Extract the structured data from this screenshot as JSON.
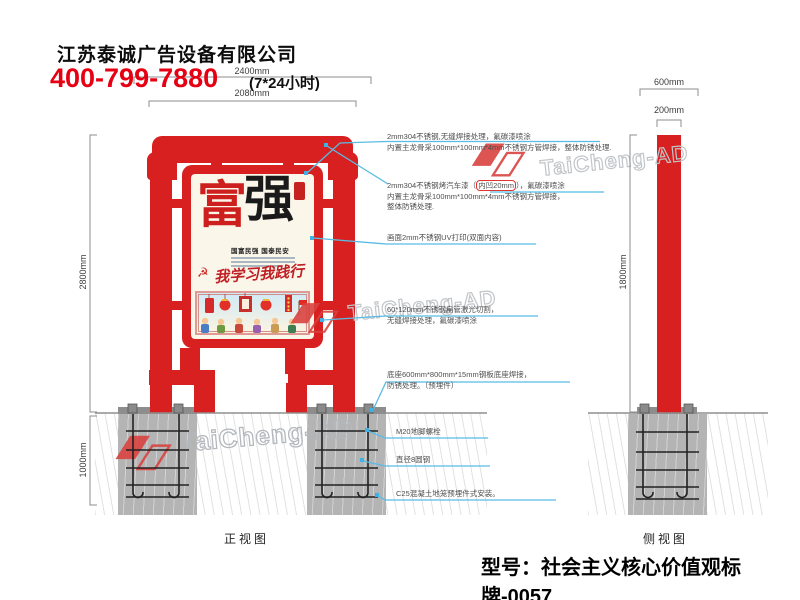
{
  "header": {
    "company": "江苏泰诚广告设备有限公司",
    "phone": "400-799-7880",
    "hours": "(7*24小时)"
  },
  "views": {
    "front_label": "正视图",
    "side_label": "侧视图"
  },
  "dimensions": {
    "front_total_width": "2400mm",
    "front_sign_width": "2080mm",
    "front_height": "2800mm",
    "foundation_depth": "1000mm",
    "side_base_width": "600mm",
    "side_pole_width": "200mm",
    "side_pole_height": "1800mm"
  },
  "poster": {
    "char1": "富",
    "char2": "强",
    "subtitle": "国富民强 国泰民安",
    "slogan": "我学习我践行",
    "emblem": "☭"
  },
  "annotations": {
    "a1": {
      "l1": "2mm304不锈钢,无缝焊接处理，氟碳漆喷涂",
      "l2": "内置主龙骨采100mm*100mm*4mm不锈钢方管焊接，整体防锈处理."
    },
    "a2": {
      "l1_pre": "2mm304不锈钢烤汽车漆（",
      "l1_hl": "内凹20mm",
      "l1_post": "），氟碳漆喷涂",
      "l2": "内置主龙骨采100mm*100mm*4mm不锈钢方管焊接，",
      "l3": "整体防锈处理."
    },
    "a3": {
      "l1": "画面2mm不锈钢UV打印(双面内容)"
    },
    "a4": {
      "l1": "60*120mm不锈钢扁管激光切割，",
      "l2": "无缝焊接处理，氟碳漆喷涂"
    },
    "a5": {
      "l1": "底座600mm*800mm*15mm钢板底座焊接，",
      "l2": "防锈处理。（预埋件）"
    },
    "a6": {
      "l1": "M20地脚螺栓"
    },
    "a7": {
      "l1": "直径8圆钢"
    },
    "a8": {
      "l1": "C25混凝土地笼预埋件式安装。"
    }
  },
  "watermark": {
    "text": "TaiCheng-AD"
  },
  "footer": {
    "model": "型号：社会主义核心价值观标牌-0057"
  },
  "colors": {
    "frame_red": "#d7201f",
    "leader_cyan": "#58bce4",
    "phone_red": "#e60013",
    "concrete": "#b4b4b4"
  }
}
